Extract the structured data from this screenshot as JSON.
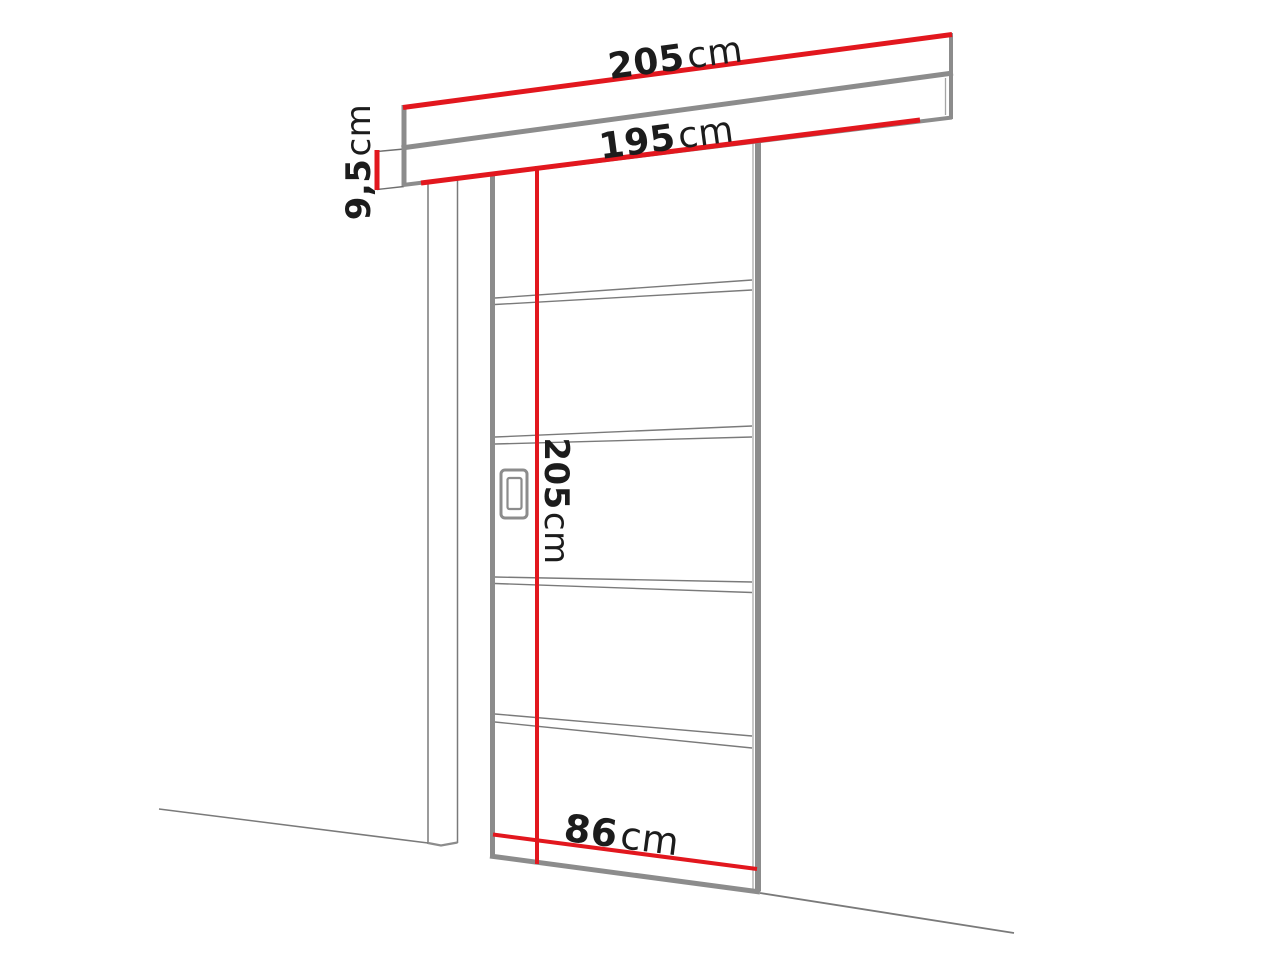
{
  "diagram": {
    "kind": "sliding-door-dimension-diagram",
    "labels": {
      "track_length": {
        "value": "205",
        "unit": "cm"
      },
      "rail_length": {
        "value": "195",
        "unit": "cm"
      },
      "track_height": {
        "value": "9,5",
        "unit": "cm"
      },
      "door_height": {
        "value": "205",
        "unit": "cm"
      },
      "door_width": {
        "value": "86",
        "unit": "cm"
      }
    },
    "colors": {
      "dimension_red": "#e2171e",
      "outline_gray": "#8c8c8c",
      "edge_gray_light": "#a5a5a5",
      "sketch_gray": "#7a7a7a",
      "thin_gray": "#6e6e6e",
      "text_black": "#1c1c1c",
      "background": "#ffffff"
    }
  }
}
